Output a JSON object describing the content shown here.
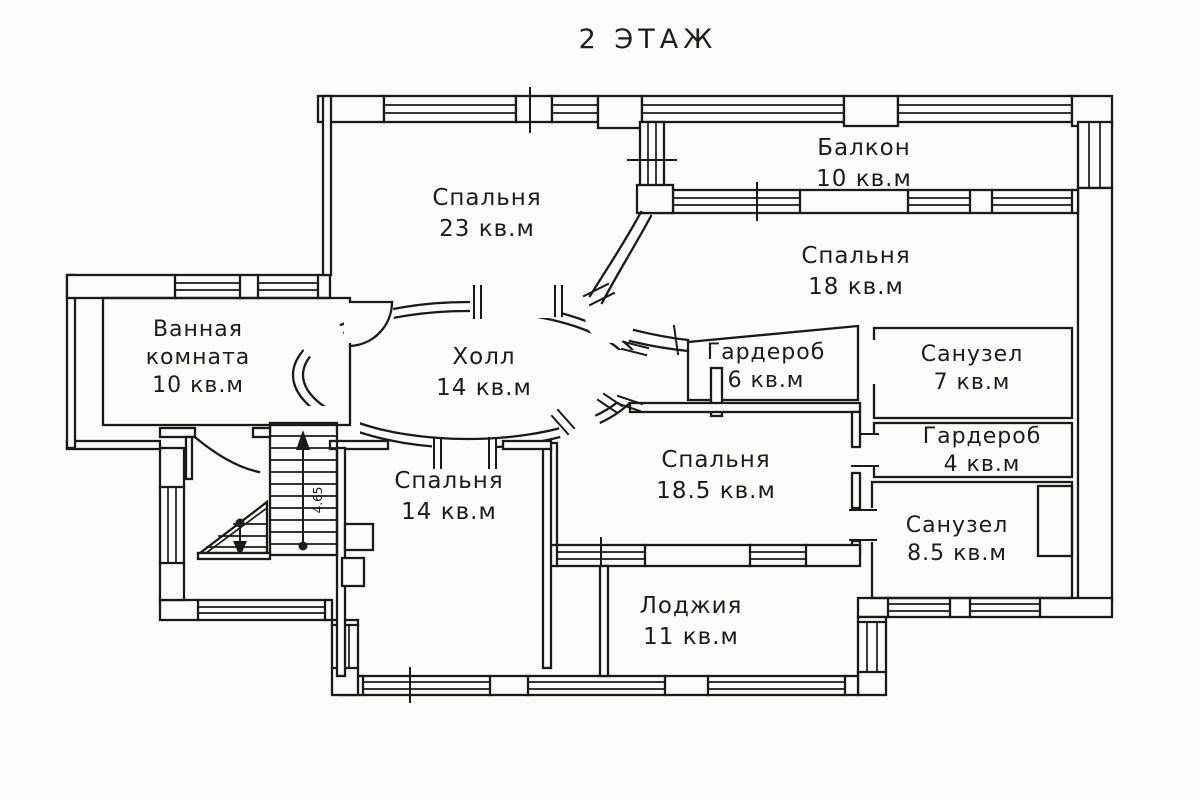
{
  "title": "2 ЭТАЖ",
  "colors": {
    "line": "#1a1a1a",
    "background": "#fcfcfb"
  },
  "floor_plan": {
    "rooms": [
      {
        "key": "bedroom-23",
        "name": "Спальня",
        "area": "23 кв.м"
      },
      {
        "key": "balcony-10",
        "name": "Балкон",
        "area": "10 кв.м"
      },
      {
        "key": "bedroom-18",
        "name": "Спальня",
        "area": "18 кв.м"
      },
      {
        "key": "bathroom-10",
        "name": "Ванная комната",
        "area": "10 кв.м"
      },
      {
        "key": "hall-14",
        "name": "Холл",
        "area": "14 кв.м"
      },
      {
        "key": "wardrobe-6",
        "name": "Гардероб",
        "area": "6 кв.м"
      },
      {
        "key": "wc-7",
        "name": "Санузел",
        "area": "7 кв.м"
      },
      {
        "key": "wardrobe-4",
        "name": "Гардероб",
        "area": "4 кв.м"
      },
      {
        "key": "bedroom-18-5",
        "name": "Спальня",
        "area": "18.5 кв.м"
      },
      {
        "key": "wc-8-5",
        "name": "Санузел",
        "area": "8.5 кв.м"
      },
      {
        "key": "bedroom-14",
        "name": "Спальня",
        "area": "14 кв.м"
      },
      {
        "key": "loggia-11",
        "name": "Лоджия",
        "area": "11 кв.м"
      }
    ],
    "stairs": {
      "dimension": "4.65"
    }
  }
}
